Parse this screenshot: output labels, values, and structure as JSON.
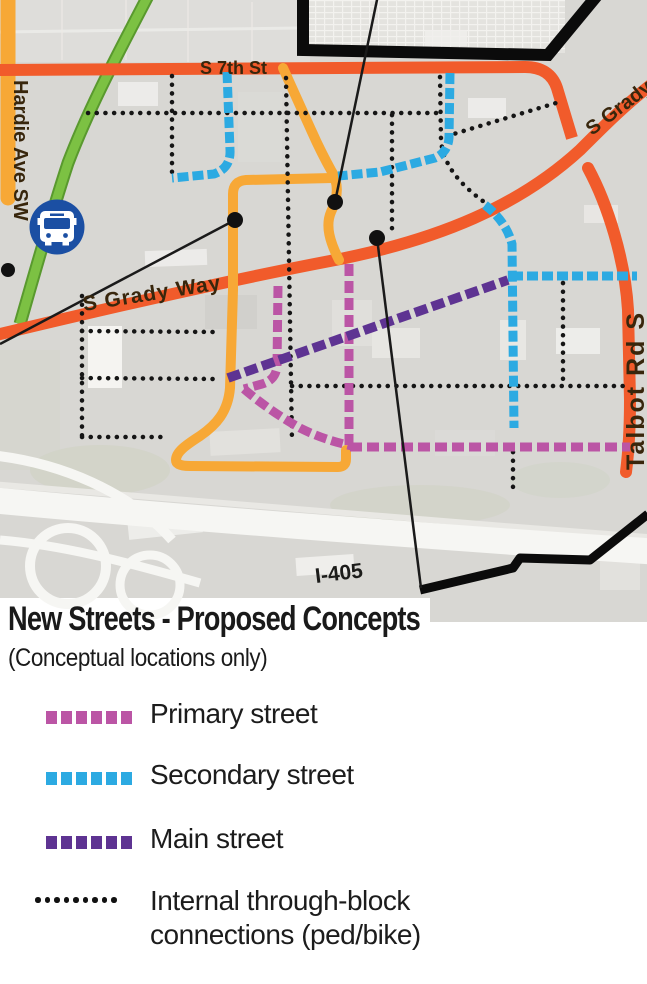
{
  "map": {
    "road_labels": {
      "s7th": "S 7th St",
      "grady": "S Grady Way",
      "grady_ne": "S Grady Way",
      "hardie": "Hardie Ave SW",
      "talbot": "Talbot Rd S",
      "i405": "I-405"
    },
    "icons": {
      "transit": "bus-icon"
    },
    "colors": {
      "major_road_orange": "#f15b2b",
      "transit_route_amber": "#f7a836",
      "green_route": "#7cc143",
      "boundary_black": "#0b0b0b",
      "transit_icon_blue": "#1b4fa3",
      "map_background": "#d8d7d3"
    }
  },
  "legend": {
    "title": "New Streets - Proposed Concepts",
    "subtitle": "(Conceptual locations only)",
    "items": [
      {
        "label": "Primary street",
        "color": "#bb55a5",
        "style": "dashed"
      },
      {
        "label": "Secondary street",
        "color": "#2caae2",
        "style": "dashed"
      },
      {
        "label": "Main street",
        "color": "#5e3392",
        "style": "dashed"
      },
      {
        "label": "Internal through-block connections (ped/bike)",
        "label_line1": "Internal through-block",
        "label_line2": "connections (ped/bike)",
        "color": "#111111",
        "style": "dotted"
      }
    ]
  }
}
